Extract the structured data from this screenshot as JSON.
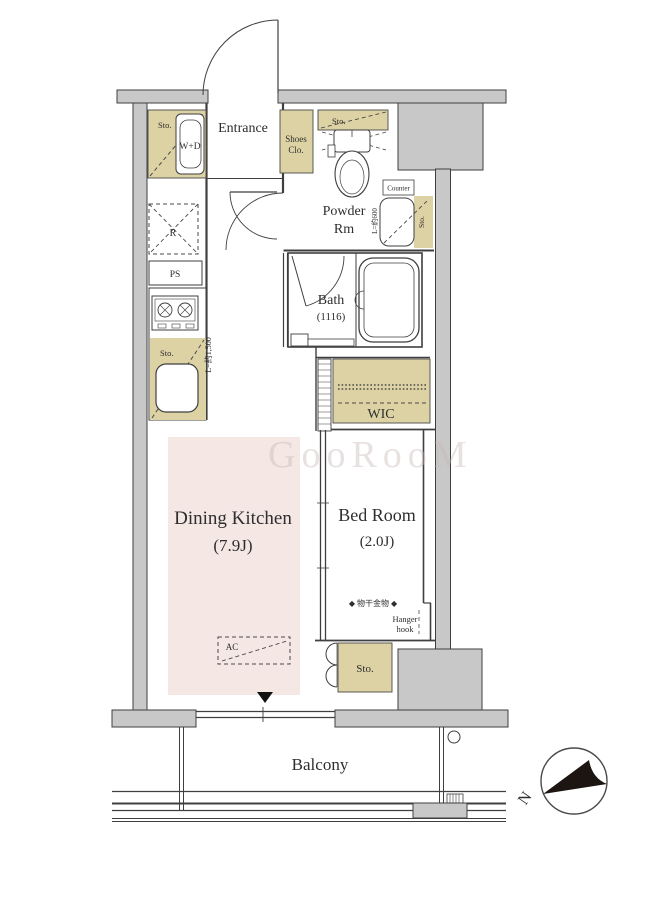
{
  "floor_plan": {
    "watermark": "GooRooM",
    "compass": {
      "north_label": "N"
    },
    "rooms": {
      "entrance": {
        "name": "Entrance"
      },
      "shoes_closet": {
        "line1": "Shoes",
        "line2": "Clo."
      },
      "powder_room": {
        "line1": "Powder",
        "line2": "Rm"
      },
      "bath": {
        "name": "Bath",
        "size": "(1116)"
      },
      "wic": {
        "name": "WIC"
      },
      "dining_kitchen": {
        "name": "Dining Kitchen",
        "size": "(7.9J)"
      },
      "bed_room": {
        "name": "Bed Room",
        "size": "(2.0J)"
      },
      "balcony": {
        "name": "Balcony"
      }
    },
    "fixtures": {
      "storage": "Sto.",
      "washer_dryer": "W+D",
      "refrigerator": "R",
      "pipe_space": "PS",
      "counter": "Counter",
      "air_conditioner": "AC",
      "hanger_hook_jp": "◆ 物干金物 ◆",
      "hanger_line1": "Hanger",
      "hanger_line2": "hook",
      "kitchen_counter_length": "L=約1,500",
      "powder_counter_length": "L=約600"
    },
    "colors": {
      "wall_gray": "#c8c8c8",
      "storage_tan": "#ddd2a4",
      "dining_kitchen_pink": "#f4e7e4",
      "line": "#3f3f3f",
      "north_arrow_black": "#1d1512"
    }
  }
}
